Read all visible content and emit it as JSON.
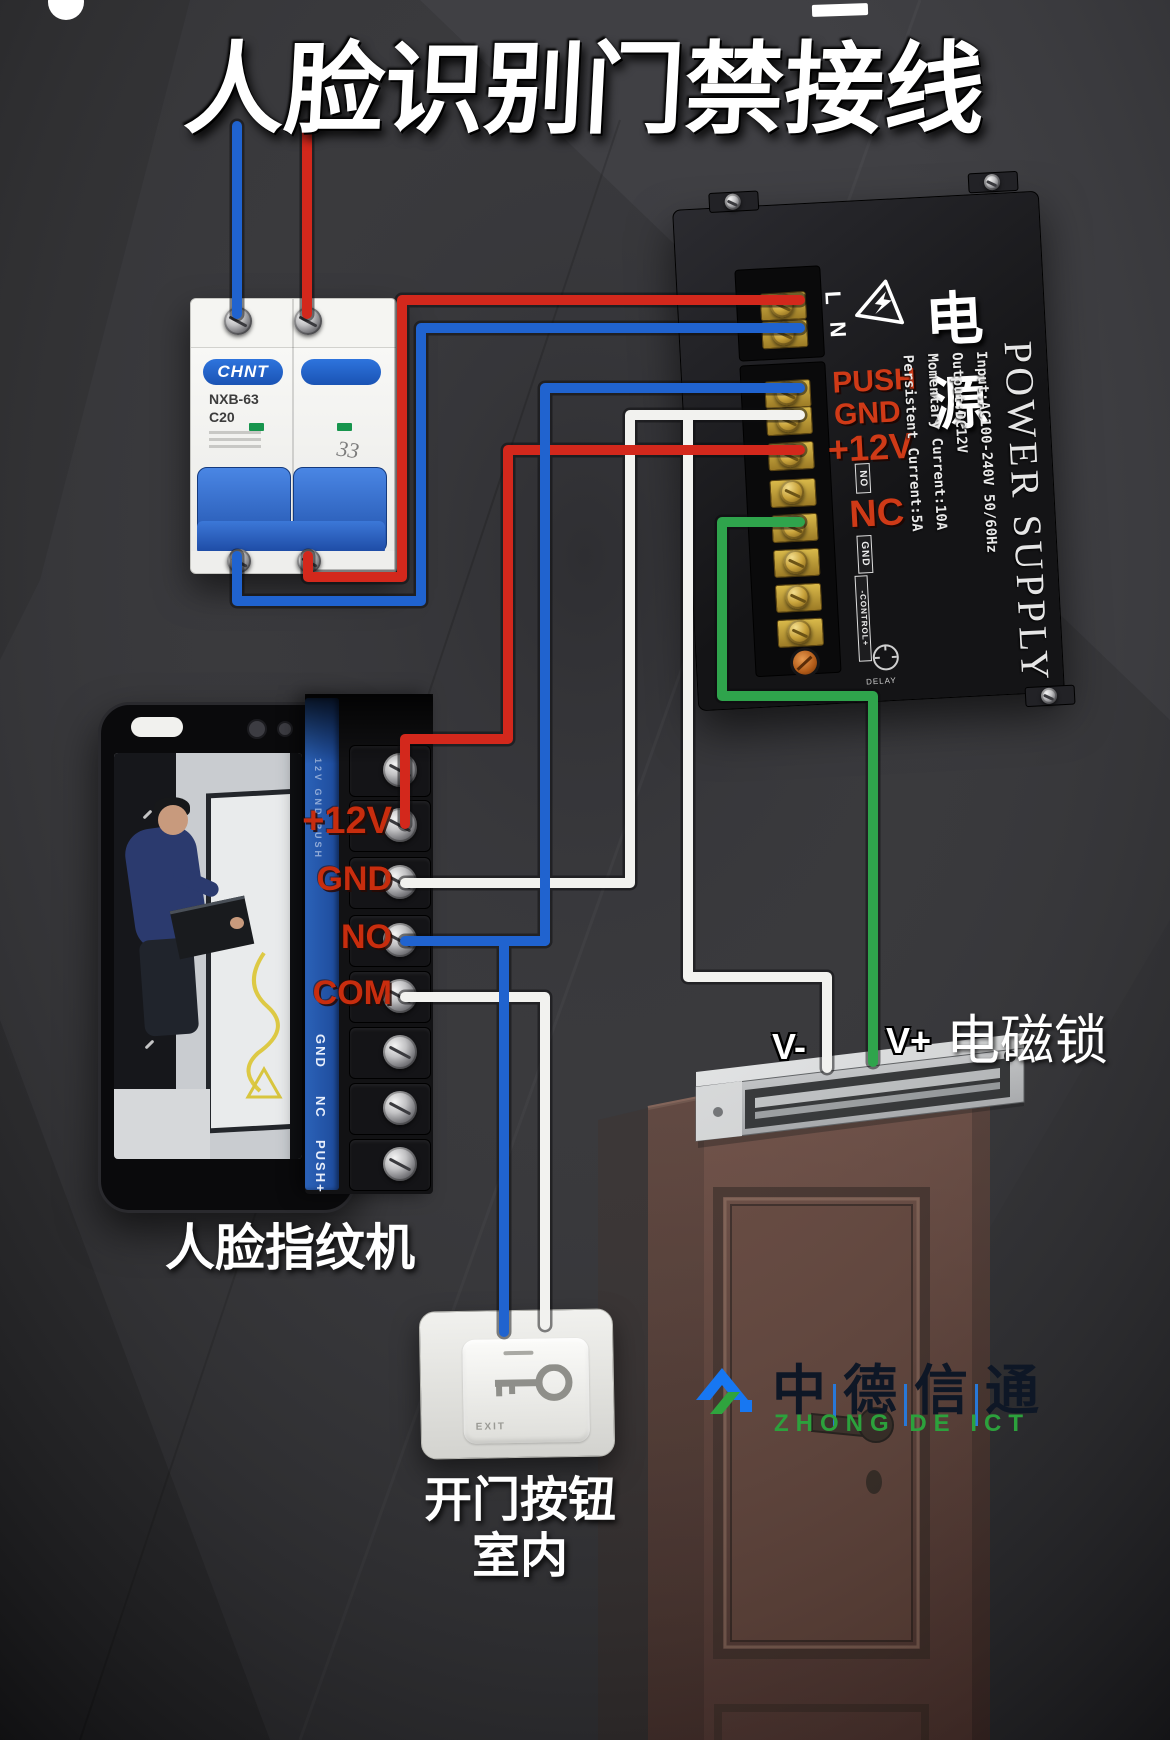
{
  "title": "人脸识别门禁接线",
  "breaker": {
    "brand": "CHNT",
    "model": "NXB-63",
    "rating": "C20",
    "scribble": "33"
  },
  "power_supply": {
    "label_cn": "电源",
    "label_en": "POWER SUPPLY",
    "line_terminals": {
      "l": "L",
      "n": "N"
    },
    "output_labels": {
      "push": "PUSH",
      "gnd": "GND",
      "v12": "+12V",
      "nc": "NC"
    },
    "boxed_labels": {
      "no": "NO",
      "gnd": "GND",
      "control": "-CONTROL+"
    },
    "specs": [
      "Input:AC100-240V 50/60Hz",
      "Output:DC12V",
      "Momentary Current:10A",
      "Persistent Current:5A"
    ],
    "delay": "DELAY"
  },
  "face_device": {
    "caption": "人脸指纹机",
    "terminals": {
      "v12": "+12V",
      "gnd": "GND",
      "no": "NO",
      "com": "COM"
    },
    "silkscreen": {
      "gnd": "GND",
      "nc": "NC",
      "push": "PUSH+"
    }
  },
  "maglock": {
    "caption": "电磁锁",
    "vminus": "V-",
    "vplus": "V+"
  },
  "exit_button": {
    "button_text": "EXIT",
    "caption_line1": "开门按钮",
    "caption_line2": "室内"
  },
  "logo": {
    "chars": [
      "中",
      "德",
      "信",
      "通"
    ],
    "en": "ZHONG DE ICT"
  },
  "wire_colors": {
    "red": "#d3281c",
    "blue": "#2063cf",
    "white": "#f2f2ef",
    "green": "#2fa44c"
  }
}
